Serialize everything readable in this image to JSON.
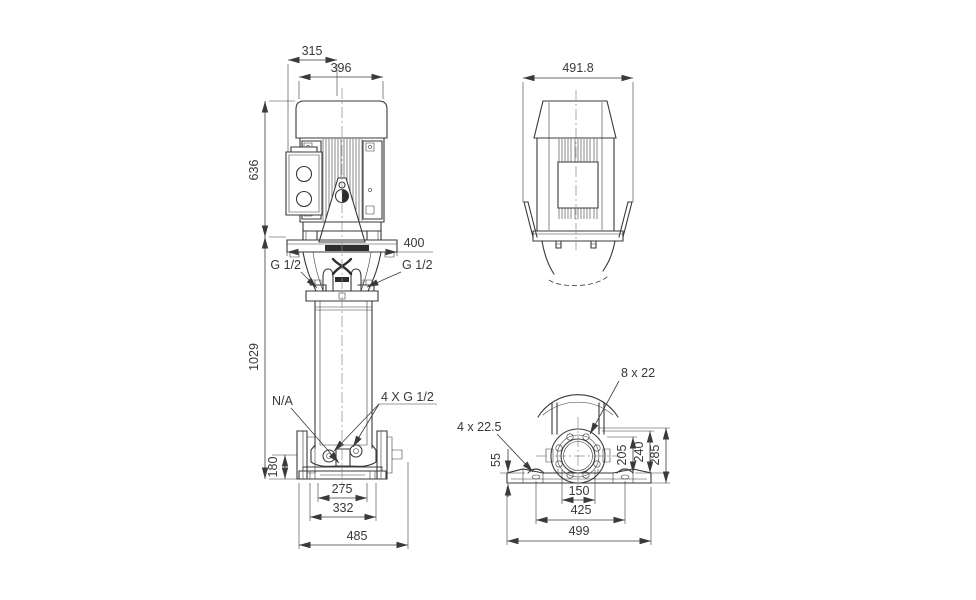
{
  "page": {
    "background": "#ffffff",
    "line_color": "#3a3a3a"
  },
  "views": {
    "front": {
      "dims": {
        "width_upper": "315",
        "width_motor": "396",
        "height_motor": "636",
        "width_stool": "400",
        "height_pump": "1029",
        "height_port": "180",
        "base_inner": "275",
        "base_mid": "332",
        "base_full": "485"
      },
      "labels": {
        "plug_left": "G 1/2",
        "plug_right": "G 1/2",
        "na": "N/A",
        "drain": "4 X G 1/2"
      }
    },
    "side": {
      "dims": {
        "depth": "491.8"
      }
    },
    "end": {
      "labels": {
        "flange_holes": "8 x 22",
        "base_holes": "4 x 22.5"
      },
      "dims": {
        "base_height": "55",
        "port_height": "205",
        "flange_mid": "240",
        "flange_top": "285",
        "hole_span": "150",
        "bolt_span": "425",
        "base_length": "499"
      }
    }
  }
}
